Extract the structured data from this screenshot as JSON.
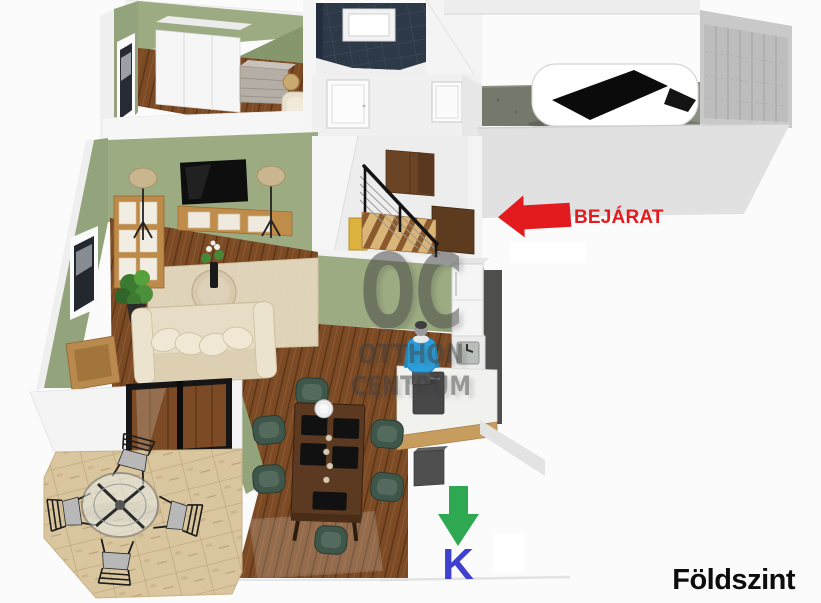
{
  "annotations": {
    "entrance_label": "BEJÁRAT",
    "compass_label": "K",
    "floor_label": "Földszint"
  },
  "watermark": {
    "logo": "OC",
    "line1": "OTTHON",
    "line2": "CENTRUM"
  },
  "colors": {
    "accent_red": "#e31b1e",
    "accent_green": "#2fa852",
    "accent_blue": "#4040cf",
    "text_black": "#0d0d0d",
    "watermark_gray": "#3f3f3f",
    "wall_green": "#9cab82",
    "wall_green_dark": "#93a37b",
    "wall_white": "#f2f2f2",
    "garage_wall_gray": "#e1e1e1",
    "floor_wood": "#7c4b26",
    "terrace_stone": "#d9c69e",
    "bathroom_tile_navy": "#2d3947",
    "furniture_wood": "#c08c4a",
    "dining_table_brown": "#5c3a21",
    "dining_chair_green": "#3f564a",
    "person_shirt_blue": "#2ba0dc"
  }
}
